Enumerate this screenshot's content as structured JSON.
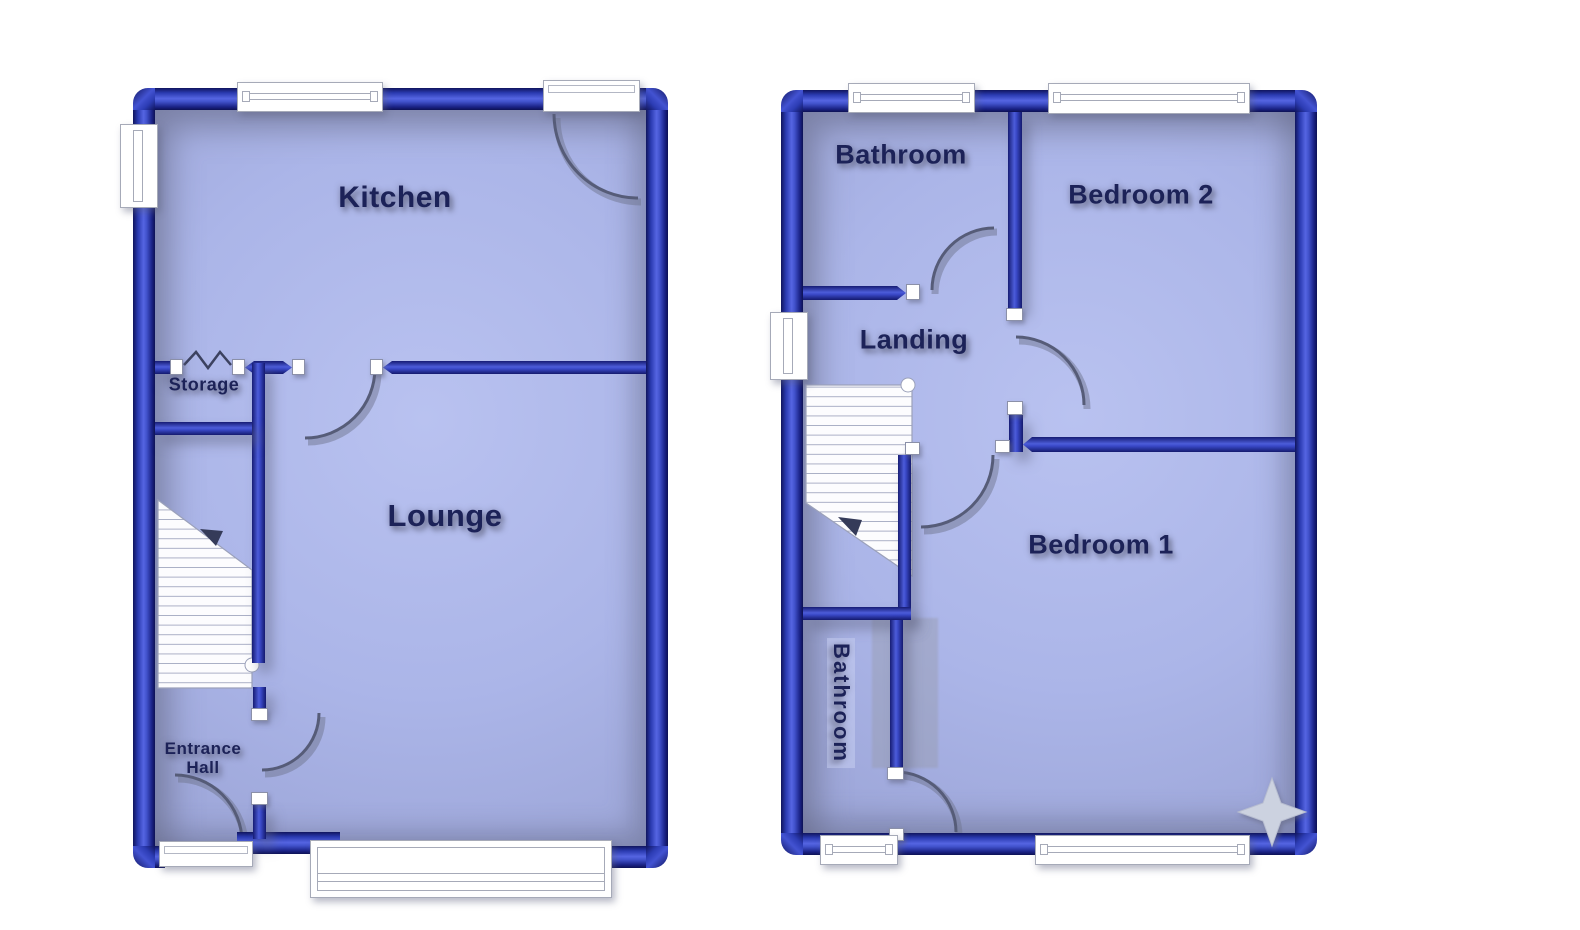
{
  "colors": {
    "background": "#ffffff",
    "wall_blue": "#3040bc",
    "wall_blue_dark": "#10155e",
    "wall_blue_light": "#5565e2",
    "floor_fill": "#abb5e8",
    "floor_shadow": "#9ba4d6",
    "label_text": "#1c2258",
    "window_white": "#ffffff",
    "window_frame_line": "#a6aab8",
    "door_arc": "#565c78",
    "stairs_fill": "#fcfcfe",
    "compass_star": "#ccd2e0"
  },
  "icons": {
    "compass_star": "four-point-star",
    "storage_folding_door": "zigzag",
    "stairs": "stair-treads"
  },
  "plans": {
    "ground": {
      "rooms": {
        "kitchen": "Kitchen",
        "storage": "Storage",
        "lounge": "Lounge",
        "entrance_hall": "Entrance Hall"
      }
    },
    "first": {
      "rooms": {
        "bathroom_top": "Bathroom",
        "bedroom2": "Bedroom 2",
        "landing": "Landing",
        "bedroom1": "Bedroom 1",
        "bathroom_bottom": "Bathroom"
      }
    }
  }
}
